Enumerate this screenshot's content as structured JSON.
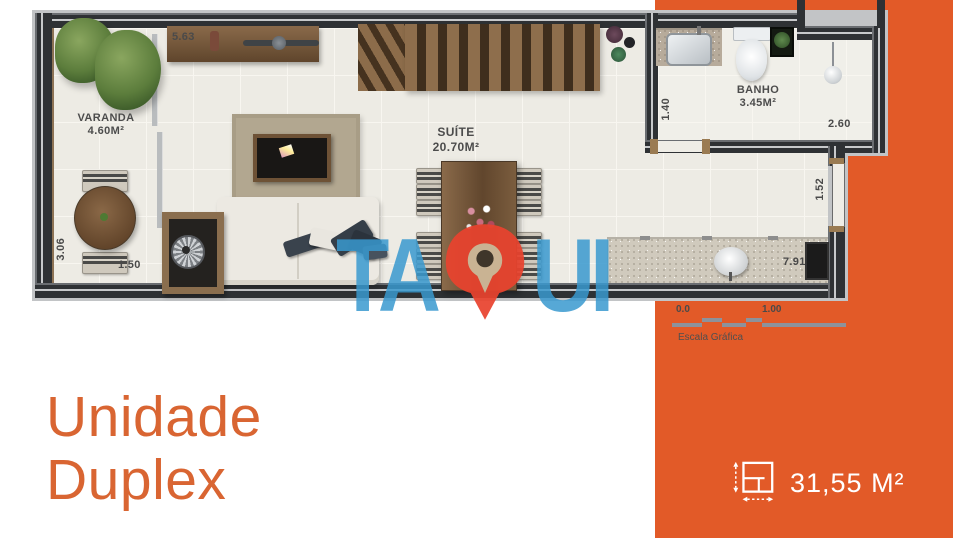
{
  "plan": {
    "rooms": {
      "varanda": {
        "name": "VARANDA",
        "area": "4.60M²"
      },
      "suite": {
        "name": "SUÍTE",
        "area": "20.70M²"
      },
      "banho": {
        "name": "BANHO",
        "area": "3.45M²"
      }
    },
    "dimensions": {
      "shelf_width": "5.63",
      "varanda_depth": "3.06",
      "varanda_width": "1.50",
      "banho_depth": "1.40",
      "banho_width": "2.60",
      "side_opening": "1.52",
      "counter_length": "7.91"
    }
  },
  "watermark": {
    "left": "TA",
    "right": "UI",
    "full": "TAQUI",
    "icon": "map-pin"
  },
  "scale_bar": {
    "tick_start": "0.0",
    "tick_one": "1.00",
    "label": "Escala Gráfica"
  },
  "title": {
    "line1": "Unidade",
    "line2": "Duplex"
  },
  "area_badge": {
    "value": "31,55 M²",
    "icon": "dimension-square-icon"
  },
  "colors": {
    "panel_orange": "#E25A28",
    "title_orange": "#D96532",
    "watermark_blue": "#3899CF",
    "pin_red": "#E8432E",
    "wall_dark": "#2E3134"
  }
}
